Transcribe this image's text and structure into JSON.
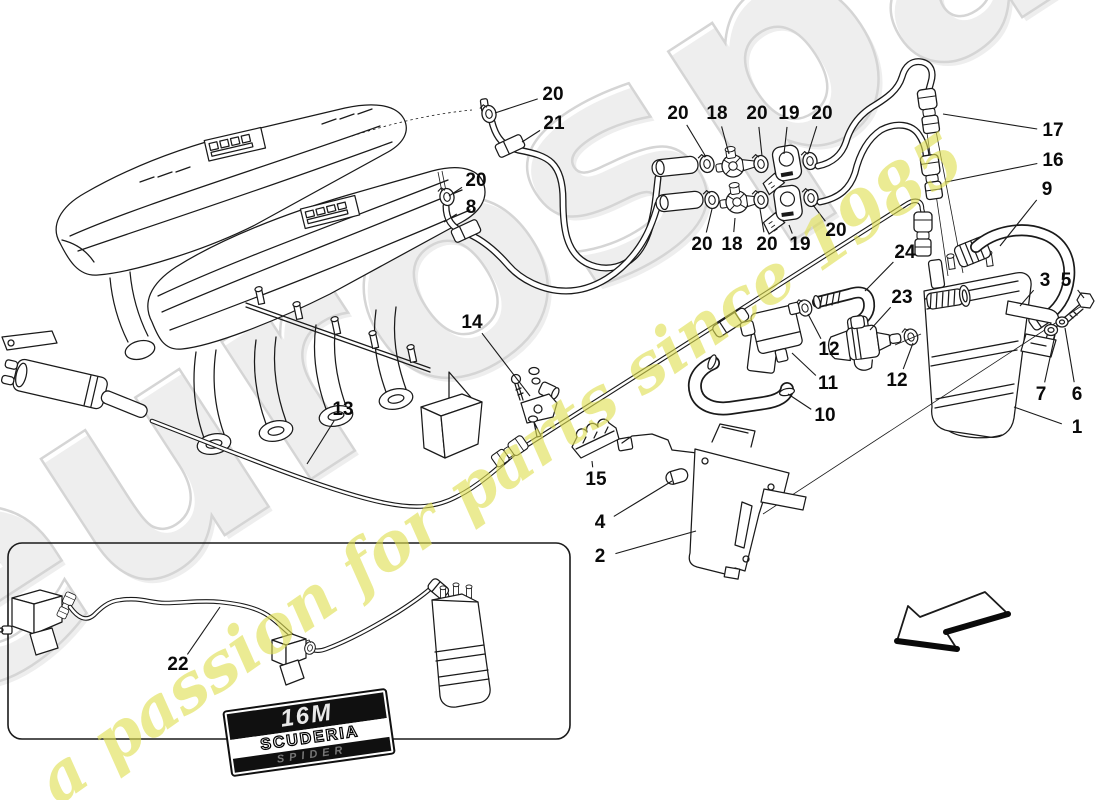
{
  "watermark": {
    "brand": "eurospares",
    "tagline": "a passion for parts since 1985",
    "brand_fill": "#e9e9e9",
    "brand_stroke": "#c7c7c7",
    "tagline_color": "#e0e052"
  },
  "badge": {
    "model": "16M",
    "series": "SCUDERIA",
    "variant": "SPIDER"
  },
  "diagram": {
    "type": "exploded-parts-diagram",
    "subject": "evaporative emissions control system with intake manifold",
    "line_color": "#1a1a1a",
    "callouts": [
      {
        "label": "20",
        "x": 553,
        "y": 95,
        "tx": 495,
        "ty": 113
      },
      {
        "label": "21",
        "x": 554,
        "y": 124,
        "tx": 522,
        "ty": 142
      },
      {
        "label": "20",
        "x": 476,
        "y": 181,
        "tx": 449,
        "ty": 196
      },
      {
        "label": "8",
        "x": 471,
        "y": 208,
        "tx": 444,
        "ty": 222
      },
      {
        "label": "20",
        "x": 678,
        "y": 114,
        "tx": 706,
        "ty": 157
      },
      {
        "label": "18",
        "x": 717,
        "y": 114,
        "tx": 729,
        "ty": 154
      },
      {
        "label": "20",
        "x": 757,
        "y": 114,
        "tx": 762,
        "ty": 156
      },
      {
        "label": "19",
        "x": 789,
        "y": 114,
        "tx": 784,
        "ty": 154
      },
      {
        "label": "20",
        "x": 822,
        "y": 114,
        "tx": 808,
        "ty": 154
      },
      {
        "label": "20",
        "x": 702,
        "y": 245,
        "tx": 712,
        "ty": 209
      },
      {
        "label": "18",
        "x": 732,
        "y": 245,
        "tx": 735,
        "ty": 218
      },
      {
        "label": "20",
        "x": 767,
        "y": 245,
        "tx": 760,
        "ty": 209
      },
      {
        "label": "19",
        "x": 800,
        "y": 245,
        "tx": 789,
        "ty": 225
      },
      {
        "label": "20",
        "x": 836,
        "y": 231,
        "tx": 813,
        "ty": 205
      },
      {
        "label": "17",
        "x": 1053,
        "y": 131,
        "tx": 943,
        "ty": 114
      },
      {
        "label": "16",
        "x": 1053,
        "y": 161,
        "tx": 946,
        "ty": 182
      },
      {
        "label": "9",
        "x": 1047,
        "y": 190,
        "tx": 1000,
        "ty": 246
      },
      {
        "label": "3",
        "x": 1045,
        "y": 281,
        "tx": 1020,
        "ty": 306
      },
      {
        "label": "5",
        "x": 1066,
        "y": 281,
        "tx": 1084,
        "ty": 298
      },
      {
        "label": "24",
        "x": 905,
        "y": 253,
        "tx": 865,
        "ty": 291
      },
      {
        "label": "23",
        "x": 902,
        "y": 298,
        "tx": 870,
        "ty": 330
      },
      {
        "label": "12",
        "x": 829,
        "y": 350,
        "tx": 808,
        "ty": 314
      },
      {
        "label": "12",
        "x": 897,
        "y": 381,
        "tx": 913,
        "ty": 343
      },
      {
        "label": "11",
        "x": 828,
        "y": 384,
        "tx": 792,
        "ty": 353
      },
      {
        "label": "10",
        "x": 825,
        "y": 416,
        "tx": 788,
        "ty": 394
      },
      {
        "label": "14",
        "x": 472,
        "y": 323,
        "tx": 530,
        "ty": 396
      },
      {
        "label": "13",
        "x": 343,
        "y": 410,
        "tx": 307,
        "ty": 464
      },
      {
        "label": "15",
        "x": 596,
        "y": 480,
        "tx": 592,
        "ty": 461
      },
      {
        "label": "4",
        "x": 600,
        "y": 523,
        "tx": 672,
        "ty": 481
      },
      {
        "label": "2",
        "x": 600,
        "y": 557,
        "tx": 696,
        "ty": 531
      },
      {
        "label": "7",
        "x": 1041,
        "y": 395,
        "tx": 1055,
        "ty": 335
      },
      {
        "label": "6",
        "x": 1077,
        "y": 395,
        "tx": 1065,
        "ty": 328
      },
      {
        "label": "1",
        "x": 1077,
        "y": 428,
        "tx": 1014,
        "ty": 407
      },
      {
        "label": "22",
        "x": 178,
        "y": 665,
        "tx": 220,
        "ty": 607
      }
    ]
  }
}
